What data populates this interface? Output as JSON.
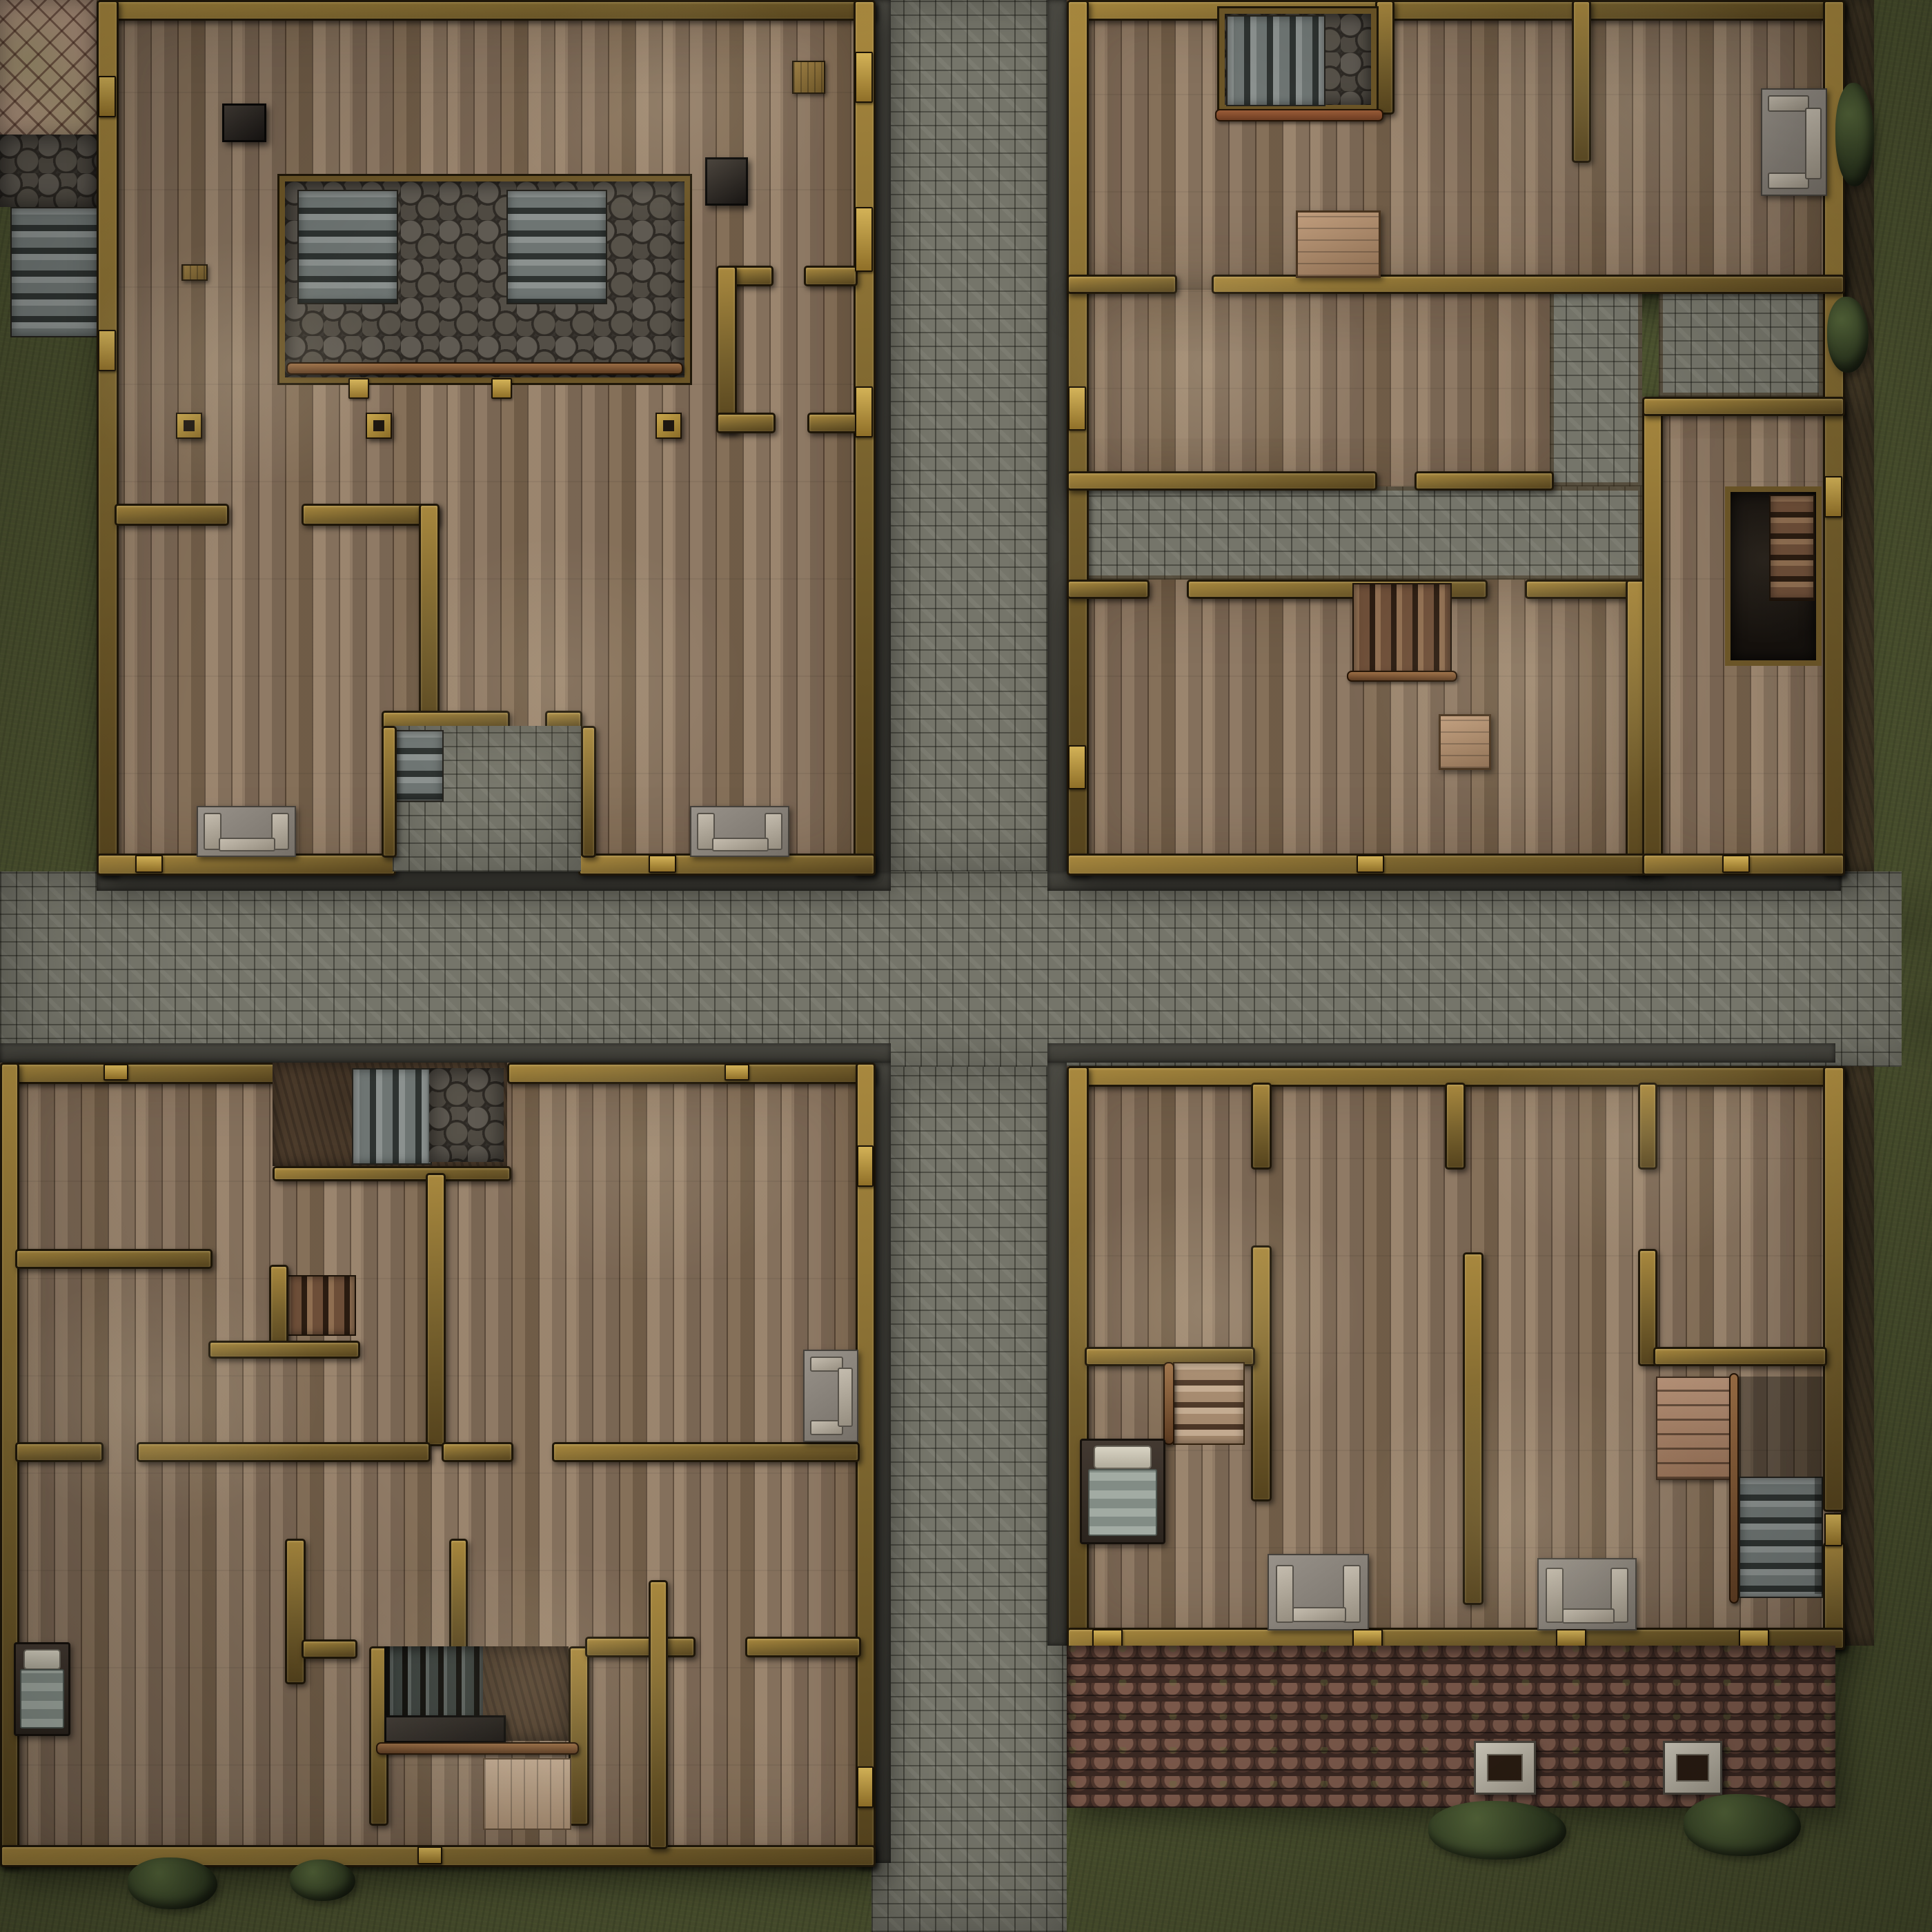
{
  "map": {
    "title": "Top-down village crossroads battlemap",
    "style": "fantasy VTT battlemap, four timber buildings around a cobblestone cross street",
    "visible_text": [],
    "palette": {
      "grass_base": "#4c5230",
      "street_base": "#75756a",
      "curb": "#3f3e38",
      "wood_base": "#8b7763",
      "wall_base": "#77612d",
      "wall_light": "#a8883e",
      "stud_gold": "#d3b257",
      "hexstone": "#37332e",
      "dirt": "#53412f",
      "roof_base": "#5c4035",
      "rooftile_patch": "#b2967f",
      "stair_gray": "#6e7573",
      "stair_brown": "#6d4e38",
      "hearth_stone": "#968e80",
      "bed_blanket": "#96a09b",
      "bush": "#39442a"
    },
    "ground": {
      "streets": [
        "north-street",
        "cross-street",
        "south-street"
      ],
      "terrain": [
        "grass-field",
        "dirt-edging",
        "stone-curbs",
        "shingle-patch-northwest",
        "hexstone-patch-northwest",
        "exterior-stairs-west"
      ]
    },
    "buildings": [
      {
        "name": "northwest-hall",
        "features": [
          "stone-courtyard-pit",
          "twin-stone-staircases",
          "guard-rail",
          "two-braziers",
          "wooden-posts",
          "two-fireplace-hearths",
          "entry-alcove-with-steps",
          "crates",
          "interior-walls",
          "doors"
        ]
      },
      {
        "name": "northeast-house",
        "features": [
          "cellar-stair-pit",
          "wooden-table",
          "fireplace-hearth",
          "stone-courtyard",
          "interior-stairs-down",
          "stool",
          "wooden-cellar-stairs",
          "interior-walls",
          "doors"
        ]
      },
      {
        "name": "southwest-house",
        "features": [
          "basement-entry-pit-with-stairs",
          "wooden-staircase",
          "fire-grate-pit",
          "charred-logs",
          "wood-pallet",
          "bed",
          "fireplace-hearth",
          "interior-walls",
          "doors"
        ]
      },
      {
        "name": "southeast-house",
        "features": [
          "bed",
          "wooden-staircase",
          "stone-steps-down",
          "storage-shelf",
          "two-fireplace-hearths",
          "tiled-roof-section",
          "two-chimneys",
          "interior-walls",
          "doors"
        ]
      }
    ],
    "vegetation": [
      "bushes-along-south-walls",
      "bushes-east-side"
    ]
  }
}
